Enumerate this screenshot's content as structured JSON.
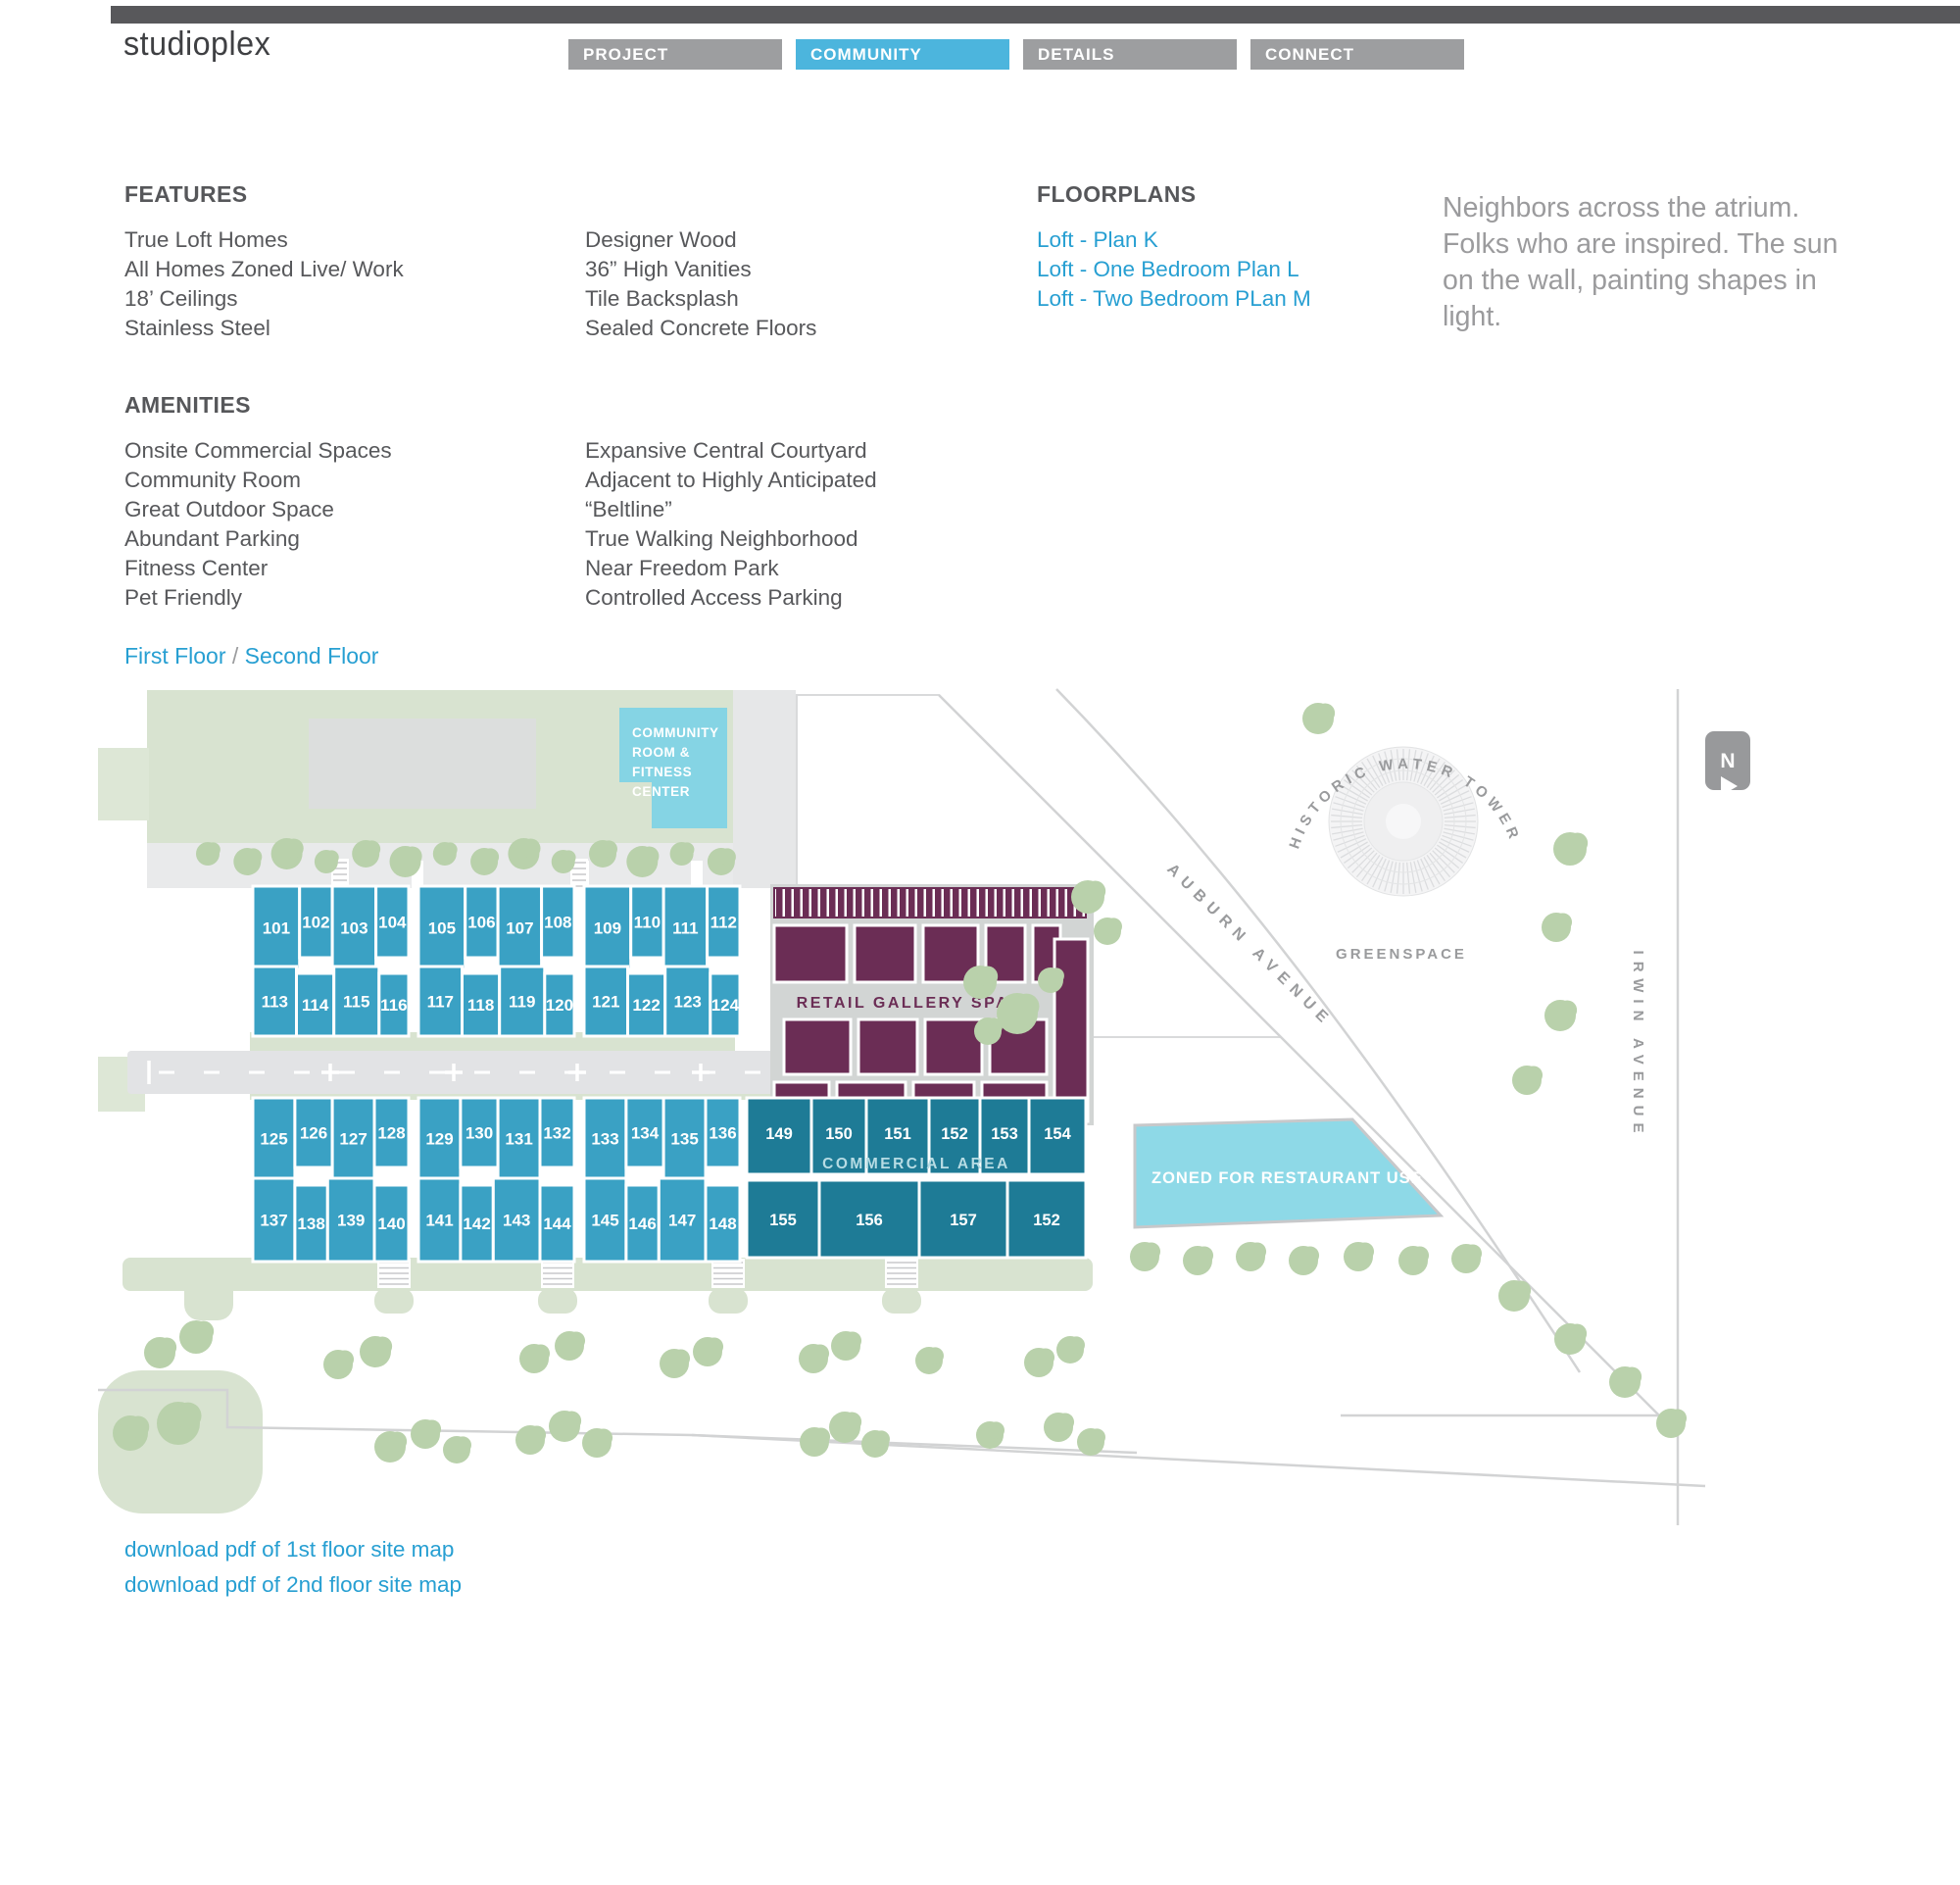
{
  "header": {
    "logo": "studioplex",
    "nav": [
      {
        "label": "PROJECT",
        "active": false
      },
      {
        "label": "COMMUNITY",
        "active": true
      },
      {
        "label": "DETAILS",
        "active": false
      },
      {
        "label": "CONNECT",
        "active": false
      }
    ]
  },
  "features": {
    "heading": "FEATURES",
    "col1": [
      "True Loft Homes",
      "All Homes Zoned Live/ Work",
      "18’ Ceilings",
      "Stainless Steel"
    ],
    "col2": [
      "Designer Wood",
      "36” High Vanities",
      "Tile Backsplash",
      "Sealed Concrete Floors"
    ]
  },
  "amenities": {
    "heading": "AMENITIES",
    "col1": [
      "Onsite Commercial Spaces",
      "Community Room",
      "Great Outdoor Space",
      "Abundant Parking",
      "Fitness Center",
      "Pet Friendly"
    ],
    "col2": [
      "Expansive Central Courtyard",
      "Adjacent to Highly Anticipated",
      "“Beltline”",
      "True Walking Neighborhood",
      "Near Freedom Park",
      "Controlled Access Parking"
    ]
  },
  "floorplans": {
    "heading": "FLOORPLANS",
    "links": [
      "Loft - Plan K",
      "Loft - One Bedroom Plan L",
      "Loft - Two Bedroom PLan M"
    ]
  },
  "quote": "Neighbors across the atrium. Folks who are inspired. The sun on the wall, painting shapes in light.",
  "floor_toggle": {
    "first": "First Floor",
    "sep": "/",
    "second": "Second Floor"
  },
  "downloads": [
    "download pdf of 1st floor site map",
    "download pdf of 2nd floor site map"
  ],
  "map": {
    "labels": {
      "community_room_lines": [
        "COMMUNITY",
        "ROOM &",
        "FITNESS",
        "CENTER"
      ],
      "retail": "RETAIL GALLERY SPACE",
      "commercial": "COMMERCIAL AREA",
      "restaurant": "ZONED FOR RESTAURANT USE",
      "auburn": "AUBURN AVENUE",
      "irwin": "IRWIN AVENUE",
      "water_tower": "HISTORIC WATER TOWER",
      "greenspace": "GREENSPACE",
      "compass_n": "N"
    },
    "unit_rows": {
      "row1": [
        "101",
        "102",
        "103",
        "104",
        "105",
        "106",
        "107",
        "108",
        "109",
        "110",
        "111",
        "112"
      ],
      "row2": [
        "113",
        "114",
        "115",
        "116",
        "117",
        "118",
        "119",
        "120",
        "121",
        "122",
        "123",
        "124"
      ],
      "row3": [
        "125",
        "126",
        "127",
        "128",
        "129",
        "130",
        "131",
        "132",
        "133",
        "134",
        "135",
        "136"
      ],
      "row4": [
        "137",
        "138",
        "139",
        "140",
        "141",
        "142",
        "143",
        "144",
        "145",
        "146",
        "147",
        "148"
      ]
    },
    "commercial_units": {
      "top": [
        "149",
        "150",
        "151",
        "152",
        "153",
        "154"
      ],
      "bottom": [
        "155",
        "156",
        "157",
        "152"
      ]
    },
    "colors": {
      "unit": "#3aa1c4",
      "commercial": "#1e7b96",
      "retail": "#6b2d55",
      "community_block": "#85d4e4",
      "restaurant_block": "#8ed9e7",
      "sage": "#d8e3d0",
      "tree": "#b9d1ab",
      "road": "#e6e7e8",
      "accent_blue": "#4cb5dd",
      "link_blue": "#279fd2",
      "map_text": "#9a9b9d"
    }
  }
}
